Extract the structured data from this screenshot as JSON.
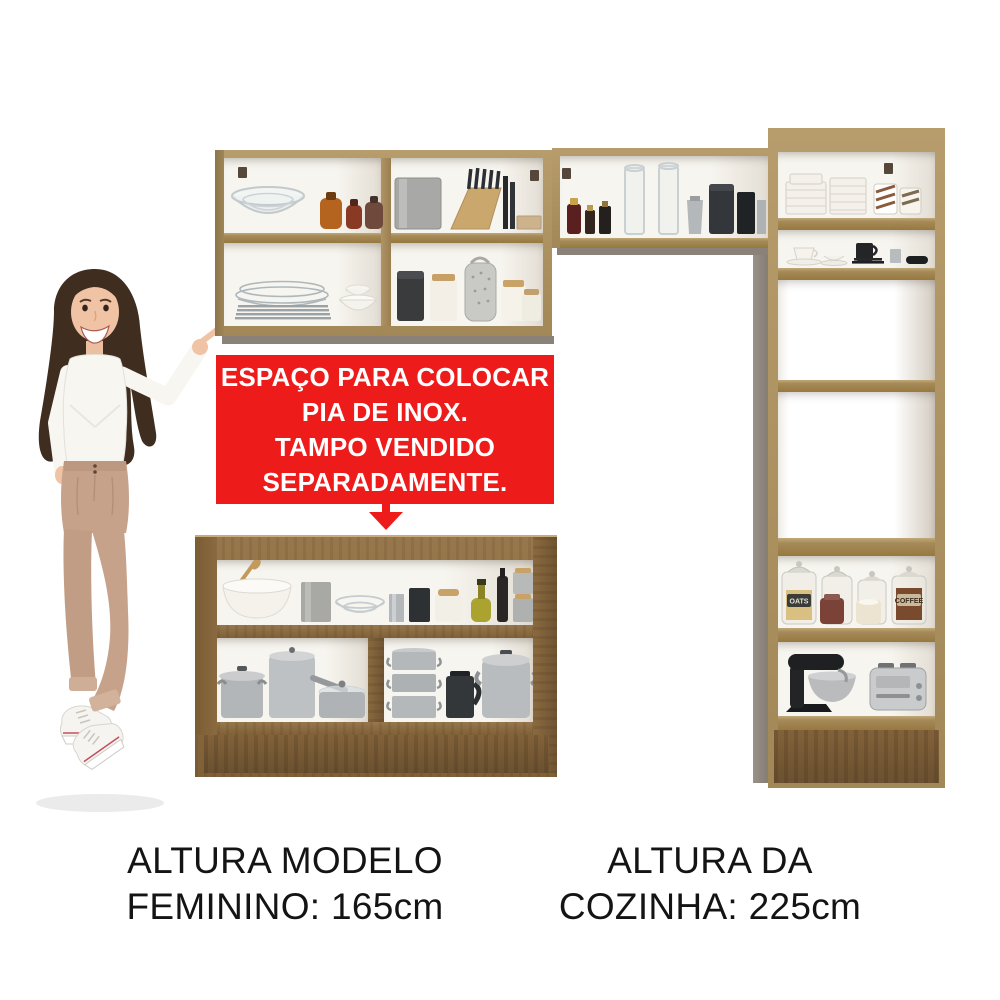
{
  "image": {
    "background": "#ffffff"
  },
  "annotation": {
    "banner": {
      "lines": [
        "ESPAÇO PARA COLOCAR",
        "PIA DE INOX.",
        "TAMPO VENDIDO",
        "SEPARADAMENTE."
      ],
      "bg_color": "#ee1b1b",
      "text_color": "#ffffff",
      "arrow_direction": "down"
    },
    "captions": {
      "left": {
        "line1": "ALTURA MODELO",
        "line2": "FEMININO: 165cm"
      },
      "right": {
        "line1": "ALTURA DA",
        "line2": "COZINHA: 225cm"
      },
      "text_color": "#141414"
    }
  },
  "kitchen_set": {
    "colors": {
      "wood_light": "#ab9061",
      "wood_dark": "#8a6a3f",
      "interior_white": "#f7f5ef",
      "side_gray": "#8e857c",
      "banner_red": "#ee1b1b"
    },
    "wall_cabinet_left": {
      "rows": 2,
      "columns": 2,
      "items": [
        "glass-bowls",
        "spice-jars",
        "metal-tin",
        "knife-block",
        "wooden-box",
        "glass-plates",
        "white-bowls",
        "black-canister",
        "white-canister",
        "grater",
        "storage-jars"
      ]
    },
    "wall_cabinet_middle": {
      "rows": 1,
      "items": [
        "small-bottles",
        "glass-cylinders",
        "metal-pitcher",
        "dark-canisters",
        "metal-box"
      ]
    },
    "tall_cabinet": {
      "compartments": 6,
      "items": [
        "white-plate-stacks",
        "striped-mugs",
        "teacup-saucer",
        "black-mug",
        "black-plates",
        "steel-cup",
        "pantry-jars",
        "ceramic-jars",
        "stand-mixer",
        "toaster"
      ],
      "jar_labels": {
        "oats": "OATS",
        "coffee": "COFFEE"
      }
    },
    "base_cabinet": {
      "rows": 2,
      "items": [
        "mixing-bowl",
        "wooden-spoon",
        "metal-tin",
        "glass-bowls",
        "steel-cup",
        "dark-canister",
        "white-jar",
        "oil-bottle",
        "dark-bottle",
        "steel-canisters",
        "lidded-pot",
        "tall-pot",
        "glass-lid-casserole",
        "steamer-stack",
        "dark-kettle",
        "stockpot"
      ]
    }
  },
  "model": {
    "subject": "woman pointing at kitchen set",
    "outfit": [
      "white-sweater",
      "beige-trousers",
      "white-sneakers"
    ]
  }
}
